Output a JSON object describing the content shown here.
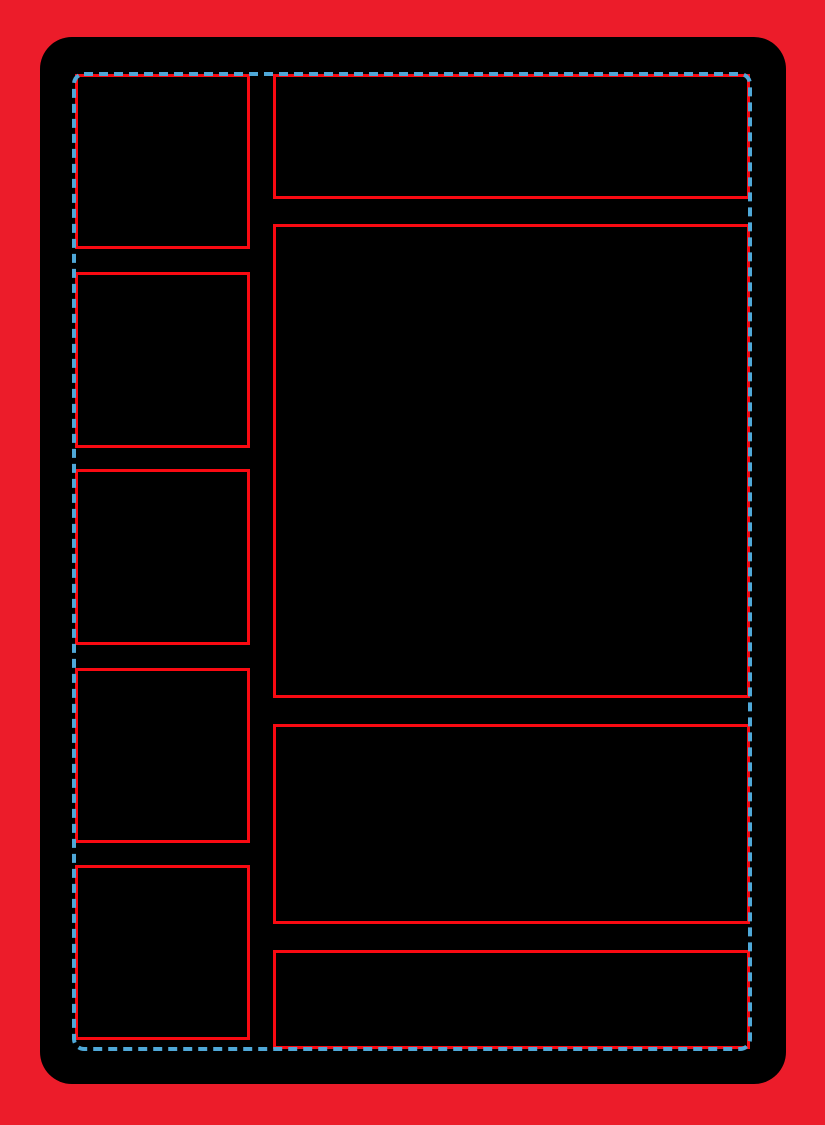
{
  "colors": {
    "page_background": "#ec1c2a",
    "card_fill": "#000000",
    "panel_outline": "#fa0a12",
    "safe_area_border": "#4fa8d8"
  },
  "template": {
    "left_column_box_count": 5,
    "right_column_box_count": 4,
    "text_content": ""
  }
}
